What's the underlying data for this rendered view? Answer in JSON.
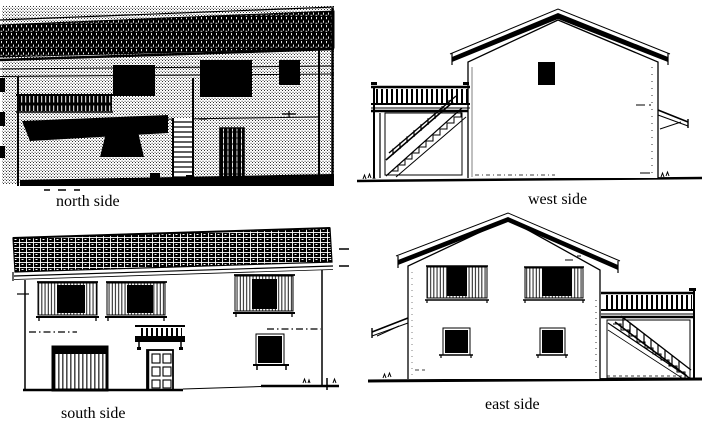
{
  "page": {
    "paper_color": "#ffffff",
    "ink_color": "#000000"
  },
  "elevations": [
    {
      "id": "north",
      "label": "north side"
    },
    {
      "id": "west",
      "label": "west side"
    },
    {
      "id": "south",
      "label": "south side"
    },
    {
      "id": "east",
      "label": "east side"
    }
  ]
}
